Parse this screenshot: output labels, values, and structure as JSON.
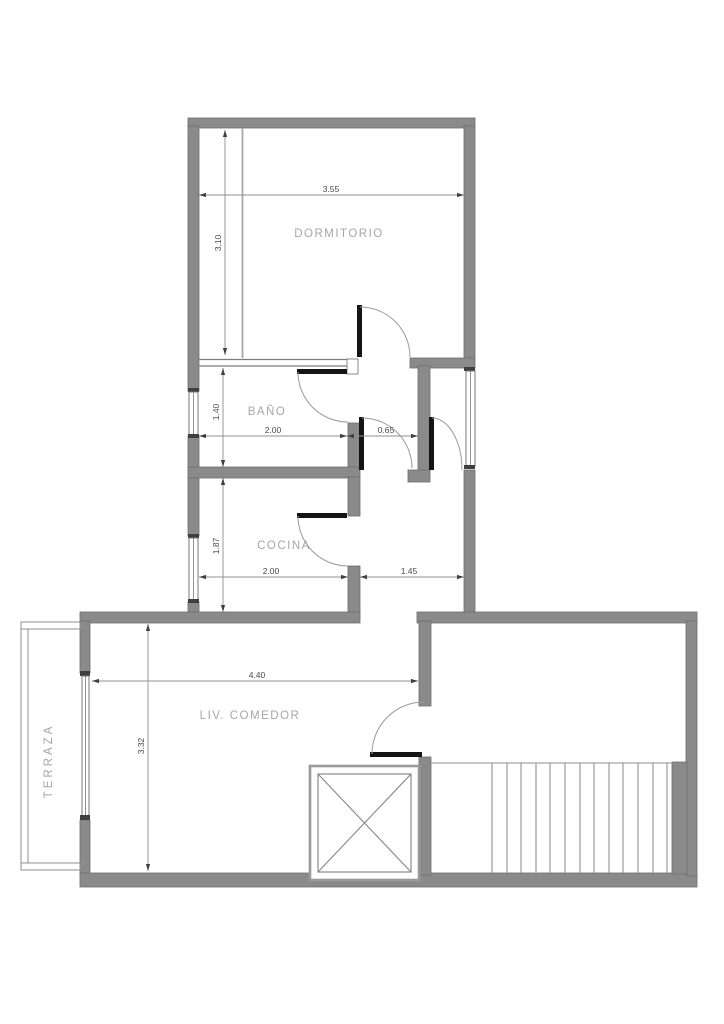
{
  "document": {
    "type": "architectural floor plan"
  },
  "rooms": {
    "dormitorio": {
      "label": "DORMITORIO"
    },
    "bano": {
      "label": "BAÑO"
    },
    "cocina": {
      "label": "COCINA"
    },
    "living": {
      "label": "LIV. COMEDOR"
    },
    "terraza": {
      "label": "TERRAZA"
    }
  },
  "dimensions": {
    "dormitorio_width": "3.55",
    "dormitorio_depth": "3.10",
    "bano_depth": "1.40",
    "bano_width": "2.00",
    "hall_passage": "0.65",
    "cocina_depth": "1.87",
    "cocina_width": "2.00",
    "entry_hall_width": "1.45",
    "living_width": "4.40",
    "living_depth": "3.32"
  },
  "colors": {
    "wall": "#8a8a8a",
    "wall_edge": "#6e6e6e",
    "door": "#141414",
    "thin_line": "#8f8f8f",
    "room_label": "#a6a6a6",
    "dim_text": "#4a4a4a",
    "background": "#ffffff"
  }
}
